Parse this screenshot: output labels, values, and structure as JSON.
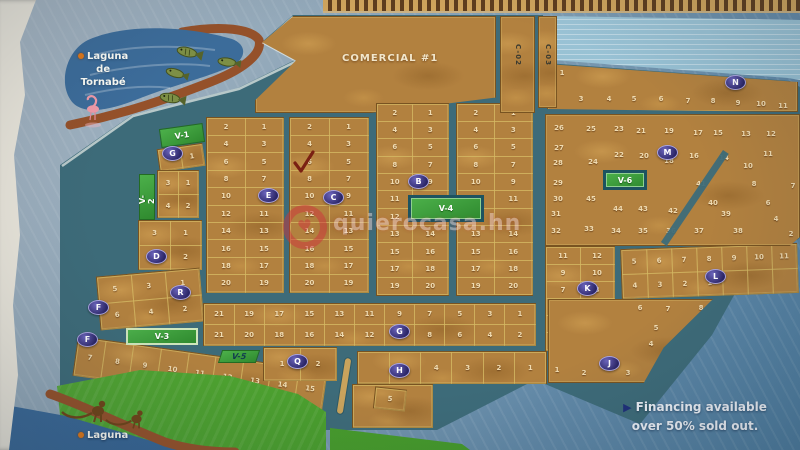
{
  "map": {
    "colors": {
      "road": "#3d6b79",
      "land": "#b2813f",
      "lotline": "rgba(214,186,100,0.55)",
      "blockborder": "rgba(96,64,22,0.7)",
      "num": "#f0dcb2",
      "green": "#3f9f3d",
      "frame": "#1d5360",
      "shore_brown": "#95512a",
      "lagoon_blue": "#3c6c9a",
      "stripe1": "#cfa45c",
      "stripe2": "#5e3d1e",
      "wm": "rgba(206,52,60,0.5)",
      "marker_fill": "#2a2566",
      "arrow_navy": "#1e2f7a"
    },
    "lagoon_label": {
      "line1": "Laguna",
      "line2": "de",
      "line3": "Tornabé"
    },
    "laguna_bottom_label": "Laguna",
    "comercial_label": "COMERCIAL #1",
    "financing": {
      "line1": "Financing available",
      "line2": "over 50% sold out."
    },
    "watermark": {
      "text": "quierocasa.hn",
      "logo": "heart-ring-logo"
    },
    "streets": [
      {
        "name": "C-02",
        "x": 500,
        "y": 16,
        "w": 35,
        "h": 97
      },
      {
        "name": "C-03",
        "x": 538,
        "y": 16,
        "w": 19,
        "h": 92
      }
    ],
    "green_areas": [
      {
        "id": "V-1",
        "label": "V-1",
        "x": 160,
        "y": 126,
        "w": 44,
        "h": 19,
        "rot": -8,
        "style": "plain"
      },
      {
        "id": "V-2",
        "label": "V-2",
        "x": 139,
        "y": 174,
        "w": 16,
        "h": 46,
        "style": "vertical"
      },
      {
        "id": "V-3",
        "label": "V-3",
        "x": 126,
        "y": 328,
        "w": 72,
        "h": 17,
        "style": "light"
      },
      {
        "id": "V-4",
        "label": "V-4",
        "x": 408,
        "y": 195,
        "w": 76,
        "h": 27,
        "style": "framed"
      },
      {
        "id": "V-5",
        "label": "V-5",
        "x": 220,
        "y": 350,
        "w": 38,
        "h": 13,
        "style": "plain-dark",
        "skew": -18
      },
      {
        "id": "V-6",
        "label": "V-6",
        "x": 603,
        "y": 170,
        "w": 44,
        "h": 20,
        "style": "framed"
      }
    ],
    "markers": [
      {
        "letter": "G",
        "x": 172,
        "y": 153
      },
      {
        "letter": "E",
        "x": 268,
        "y": 195
      },
      {
        "letter": "C",
        "x": 333,
        "y": 197
      },
      {
        "letter": "B",
        "x": 418,
        "y": 181
      },
      {
        "letter": "D",
        "x": 156,
        "y": 256
      },
      {
        "letter": "R",
        "x": 180,
        "y": 292
      },
      {
        "letter": "F",
        "x": 98,
        "y": 307
      },
      {
        "letter": "F",
        "x": 87,
        "y": 339
      },
      {
        "letter": "Q",
        "x": 297,
        "y": 361
      },
      {
        "letter": "G",
        "x": 399,
        "y": 331
      },
      {
        "letter": "H",
        "x": 399,
        "y": 370
      },
      {
        "letter": "K",
        "x": 587,
        "y": 288
      },
      {
        "letter": "L",
        "x": 715,
        "y": 276
      },
      {
        "letter": "J",
        "x": 609,
        "y": 363
      },
      {
        "letter": "M",
        "x": 667,
        "y": 152
      },
      {
        "letter": "N",
        "x": 735,
        "y": 82
      }
    ],
    "blocks": [
      {
        "id": "comercial",
        "x": 255,
        "y": 16,
        "w": 241,
        "h": 97,
        "clip": "polygon(16% 0%,3% 27%,17% 46%,0% 87%,0% 100%,48% 100%,100% 84%,100% 0%)",
        "text": {
          "bind": "comercial_label",
          "left": "36%",
          "top": "38%"
        }
      },
      {
        "id": "blk1",
        "x": 206,
        "y": 117,
        "w": 78,
        "h": 176,
        "rows": [
          [
            "2",
            "1"
          ],
          [
            "4",
            "3"
          ],
          [
            "6",
            "5"
          ],
          [
            "8",
            "7"
          ],
          [
            "10",
            "9"
          ],
          [
            "12",
            "11"
          ],
          [
            "14",
            "13"
          ],
          [
            "16",
            "15"
          ],
          [
            "18",
            "17"
          ],
          [
            "20",
            "19"
          ]
        ]
      },
      {
        "id": "blk2",
        "x": 289,
        "y": 117,
        "w": 80,
        "h": 176,
        "rows": [
          [
            "2",
            "1"
          ],
          [
            "4",
            "3"
          ],
          [
            "6",
            "5"
          ],
          [
            "8",
            "7"
          ],
          [
            "10",
            "9"
          ],
          [
            "12",
            "11"
          ],
          [
            "14",
            "13"
          ],
          [
            "16",
            "15"
          ],
          [
            "18",
            "17"
          ],
          [
            "20",
            "19"
          ]
        ]
      },
      {
        "id": "blk3",
        "x": 376,
        "y": 103,
        "w": 73,
        "h": 193,
        "rows": [
          [
            "2",
            "1"
          ],
          [
            "4",
            "3"
          ],
          [
            "6",
            "5"
          ],
          [
            "8",
            "7"
          ],
          [
            "10",
            "9"
          ],
          [
            "11",
            ""
          ],
          [
            "12",
            ""
          ],
          [
            "13",
            "14"
          ],
          [
            "15",
            "16"
          ],
          [
            "17",
            "18"
          ],
          [
            "19",
            "20"
          ]
        ]
      },
      {
        "id": "blk4",
        "x": 456,
        "y": 103,
        "w": 77,
        "h": 193,
        "rows": [
          [
            "2",
            "1"
          ],
          [
            "4",
            "3"
          ],
          [
            "6",
            "5"
          ],
          [
            "8",
            "7"
          ],
          [
            "10",
            "9"
          ],
          [
            "",
            "11"
          ],
          [
            "",
            ""
          ],
          [
            "13",
            "14"
          ],
          [
            "15",
            "16"
          ],
          [
            "17",
            "18"
          ],
          [
            "19",
            "20"
          ]
        ]
      },
      {
        "id": "blkV1lot",
        "x": 158,
        "y": 146,
        "w": 46,
        "h": 23,
        "rot": -8,
        "rows": [
          [
            "",
            "1"
          ]
        ]
      },
      {
        "id": "blkV2lots",
        "x": 157,
        "y": 170,
        "w": 42,
        "h": 48,
        "rows": [
          [
            "3",
            "1"
          ],
          [
            "4",
            "2"
          ]
        ]
      },
      {
        "id": "blkD",
        "x": 138,
        "y": 220,
        "w": 64,
        "h": 50,
        "rows": [
          [
            "3",
            "1"
          ],
          [
            "4",
            "2"
          ]
        ]
      },
      {
        "id": "blkFR",
        "x": 98,
        "y": 272,
        "w": 104,
        "h": 54,
        "rot": -5,
        "rows": [
          [
            "5",
            "3",
            "1"
          ],
          [
            "6",
            "4",
            "2"
          ]
        ]
      },
      {
        "id": "blkBL",
        "x": 78,
        "y": 336,
        "w": 252,
        "h": 40,
        "rot": 8,
        "origin": "top left",
        "rows": [
          [
            "7",
            "8",
            "9",
            "10",
            "11",
            "12",
            "13",
            "14",
            "15"
          ]
        ]
      },
      {
        "id": "longblk",
        "x": 203,
        "y": 303,
        "w": 333,
        "h": 43,
        "rows": [
          [
            "21",
            "19",
            "17",
            "15",
            "13",
            "11",
            "9",
            "7",
            "5",
            "3",
            "1"
          ],
          [
            "21",
            "20",
            "18",
            "16",
            "14",
            "12",
            "10",
            "8",
            "6",
            "4",
            "2"
          ]
        ]
      },
      {
        "id": "blkQ",
        "x": 263,
        "y": 347,
        "w": 74,
        "h": 34,
        "rows": [
          [
            "1",
            "2"
          ]
        ]
      },
      {
        "id": "blkH",
        "x": 357,
        "y": 351,
        "w": 190,
        "h": 33,
        "rows": [
          [
            "",
            "",
            "4",
            "3",
            "2",
            "1"
          ]
        ]
      },
      {
        "id": "fillerBottom",
        "x": 352,
        "y": 384,
        "w": 81,
        "h": 44,
        "rows": [
          [
            ""
          ]
        ]
      },
      {
        "id": "blkLot5",
        "x": 374,
        "y": 388,
        "w": 32,
        "h": 22,
        "rot": 6,
        "rows": [
          [
            "5"
          ]
        ]
      },
      {
        "id": "blkK",
        "x": 545,
        "y": 246,
        "w": 70,
        "h": 105,
        "rows": [
          [
            "11",
            "12"
          ],
          [
            "9",
            "10"
          ],
          [
            "7",
            "8"
          ],
          [
            "5",
            "6"
          ],
          [
            "3",
            "4"
          ],
          [
            "1",
            "2"
          ]
        ]
      },
      {
        "id": "blkL",
        "x": 621,
        "y": 246,
        "w": 177,
        "h": 50,
        "rot": -2,
        "rows": [
          [
            "5",
            "6",
            "7",
            "8",
            "9",
            "10",
            "11"
          ],
          [
            "4",
            "3",
            "2",
            "1",
            "",
            "",
            ""
          ]
        ]
      },
      {
        "id": "blkCanal",
        "x": 547,
        "y": 62,
        "w": 251,
        "h": 50,
        "clip": "polygon(0% 4%,100% 40%,100% 100%,0% 94%)",
        "labels": [
          [
            "1",
            14,
            10
          ],
          [
            "2",
            5,
            36
          ],
          [
            "3",
            33,
            36
          ],
          [
            "4",
            61,
            36
          ],
          [
            "5",
            86,
            36
          ],
          [
            "6",
            113,
            36
          ],
          [
            "7",
            140,
            38
          ],
          [
            "8",
            165,
            38
          ],
          [
            "9",
            190,
            40
          ],
          [
            "10",
            213,
            41
          ],
          [
            "11",
            235,
            43
          ]
        ]
      },
      {
        "id": "blkNE",
        "x": 545,
        "y": 114,
        "w": 255,
        "h": 132,
        "clip": "polygon(0% 0%,100% 0%,100% 93%,96% 100%,0% 100%)",
        "labels": [
          [
            "26",
            13,
            13
          ],
          [
            "25",
            45,
            14
          ],
          [
            "23",
            73,
            14
          ],
          [
            "21",
            95,
            16
          ],
          [
            "19",
            123,
            16
          ],
          [
            "17",
            152,
            18
          ],
          [
            "15",
            172,
            18
          ],
          [
            "13",
            200,
            19
          ],
          [
            "12",
            225,
            19
          ],
          [
            "27",
            13,
            33
          ],
          [
            "24",
            47,
            47
          ],
          [
            "22",
            73,
            40
          ],
          [
            "20",
            98,
            41
          ],
          [
            "18",
            123,
            46
          ],
          [
            "16",
            148,
            41
          ],
          [
            "14",
            178,
            43
          ],
          [
            "28",
            12,
            48
          ],
          [
            "29",
            12,
            68
          ],
          [
            "30",
            12,
            84
          ],
          [
            "31",
            10,
            99
          ],
          [
            "32",
            10,
            116
          ],
          [
            "33",
            43,
            114
          ],
          [
            "34",
            70,
            116
          ],
          [
            "35",
            97,
            116
          ],
          [
            "36",
            125,
            116
          ],
          [
            "37",
            153,
            116
          ],
          [
            "38",
            192,
            116
          ],
          [
            "39",
            180,
            99
          ],
          [
            "40",
            167,
            88
          ],
          [
            "41",
            155,
            69
          ],
          [
            "42",
            127,
            96
          ],
          [
            "43",
            97,
            94
          ],
          [
            "44",
            72,
            94
          ],
          [
            "45",
            45,
            84
          ],
          [
            "11",
            222,
            39
          ],
          [
            "10",
            202,
            51
          ],
          [
            "8",
            208,
            69
          ],
          [
            "7",
            247,
            71
          ],
          [
            "6",
            222,
            88
          ],
          [
            "4",
            230,
            104
          ],
          [
            "2",
            245,
            119
          ]
        ]
      },
      {
        "id": "blkJ",
        "x": 548,
        "y": 299,
        "w": 165,
        "h": 84,
        "clip": "polygon(0% 0%,100% 0%,70% 58%,58% 100%,0% 100%)",
        "labels": [
          [
            "6",
            91,
            8
          ],
          [
            "7",
            119,
            9
          ],
          [
            "8",
            152,
            8
          ],
          [
            "5",
            107,
            28
          ],
          [
            "4",
            102,
            44
          ],
          [
            "3",
            79,
            73
          ],
          [
            "2",
            35,
            73
          ],
          [
            "1",
            8,
            70
          ]
        ]
      }
    ],
    "annotations": {
      "checkmark": {
        "x": 295,
        "y": 152,
        "meaning": "check-mark on lot 6"
      }
    }
  }
}
